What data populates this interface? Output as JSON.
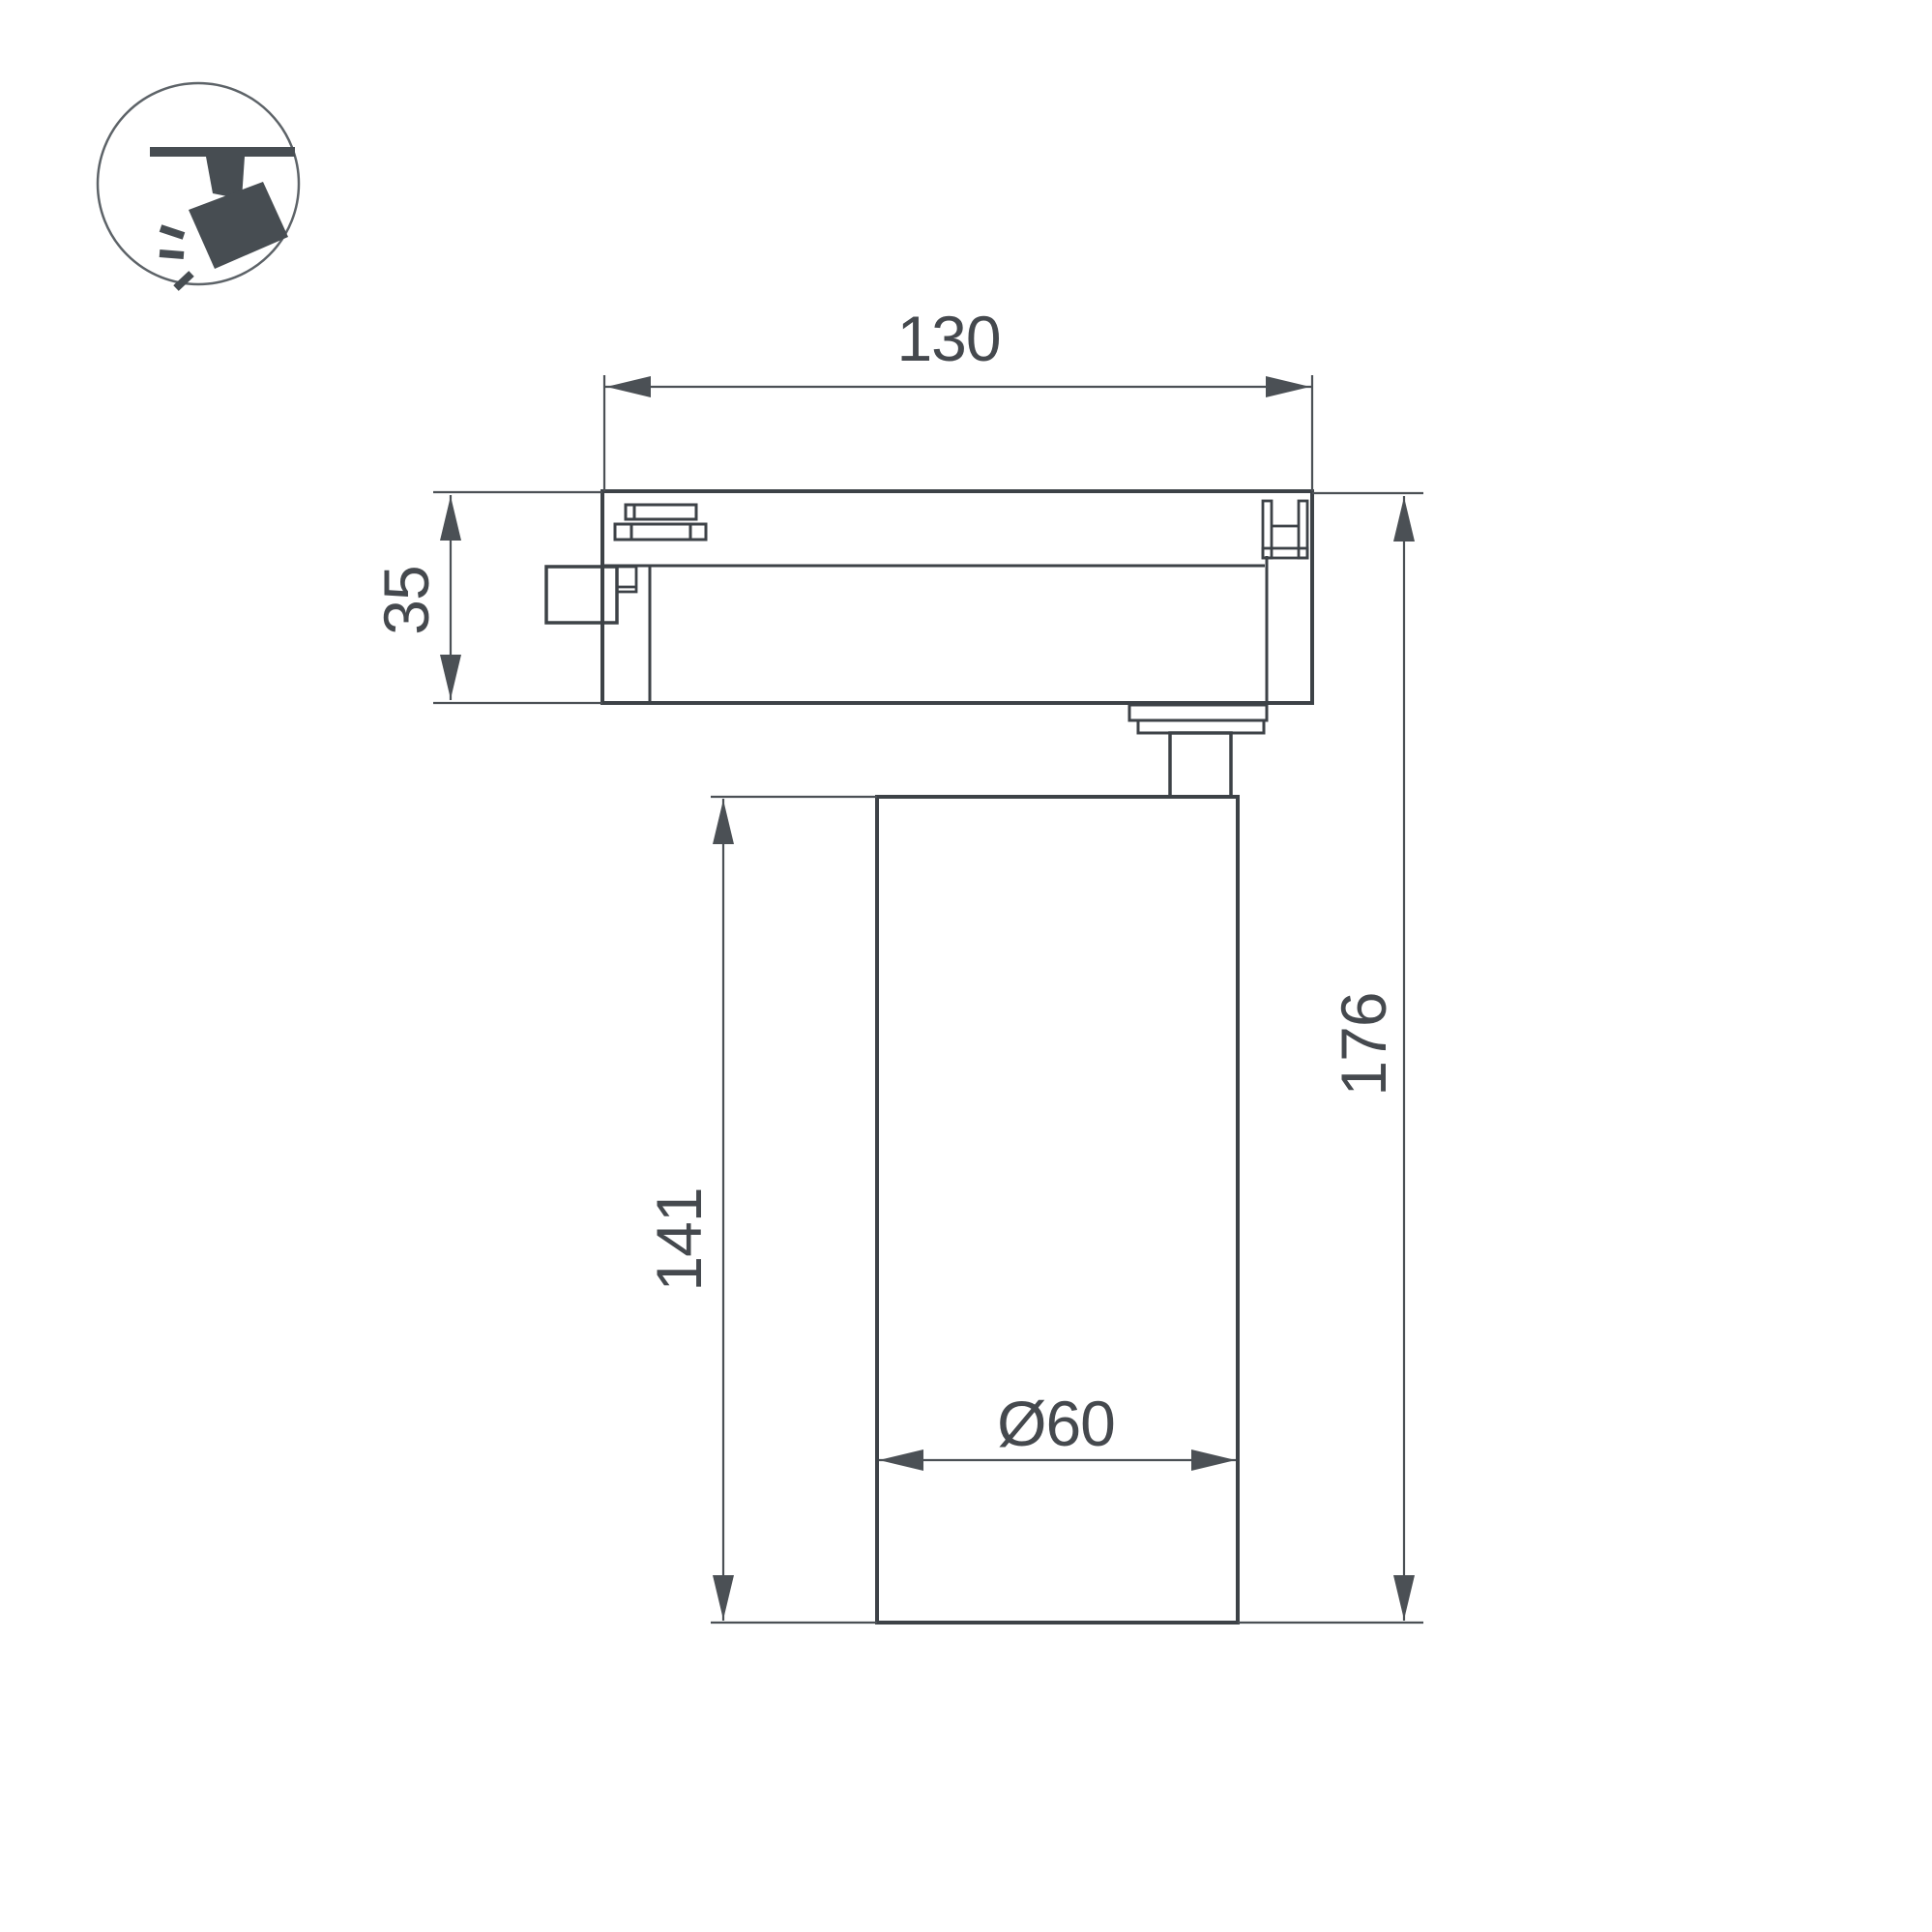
{
  "page": {
    "background": "#ffffff"
  },
  "icon": {
    "name": "track-spotlight-icon",
    "glyph_color": "#474d52",
    "ring_color": "#5d6368"
  },
  "drawing": {
    "type": "technical-drawing",
    "subject": "LED track spotlight, side projection with dimensions",
    "line_color": "#3d4247",
    "dimension_color": "#4b5055",
    "text_color": "#45494e",
    "dimensions": {
      "track_width": "130",
      "adapter_height": "35",
      "body_length": "141",
      "total_height": "176",
      "body_diameter": "Ø60"
    }
  }
}
